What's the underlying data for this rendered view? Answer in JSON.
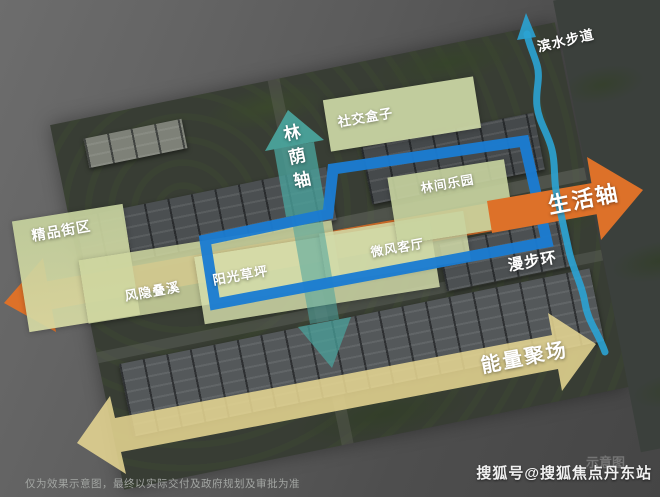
{
  "zones": [
    {
      "name": "boutique-block",
      "label": "精品街区"
    },
    {
      "name": "hidden-cascade",
      "label": "风隐叠溪"
    },
    {
      "name": "sunny-lawn",
      "label": "阳光草坪"
    },
    {
      "name": "breeze-lounge",
      "label": "微风客厅"
    },
    {
      "name": "forest-playground",
      "label": "林间乐园"
    },
    {
      "name": "social-box",
      "label": "社交盒子"
    }
  ],
  "axes": {
    "forest": {
      "label": "林荫轴",
      "color": "#4aa39c"
    },
    "life": {
      "label": "生活轴",
      "color": "#dd7129"
    },
    "stroll": {
      "label": "漫步环",
      "color": "#1b7cd1"
    },
    "energy": {
      "label": "能量聚场",
      "color": "#ead991"
    },
    "waterfront": {
      "label": "滨水步道",
      "color": "#2ba3d3"
    }
  },
  "footer": {
    "disclaimer": "仅为效果示意图，最终以实际交付及政府规划及审批为准",
    "watermark": "示意图",
    "credit": "搜狐号@搜狐焦点丹东站"
  }
}
